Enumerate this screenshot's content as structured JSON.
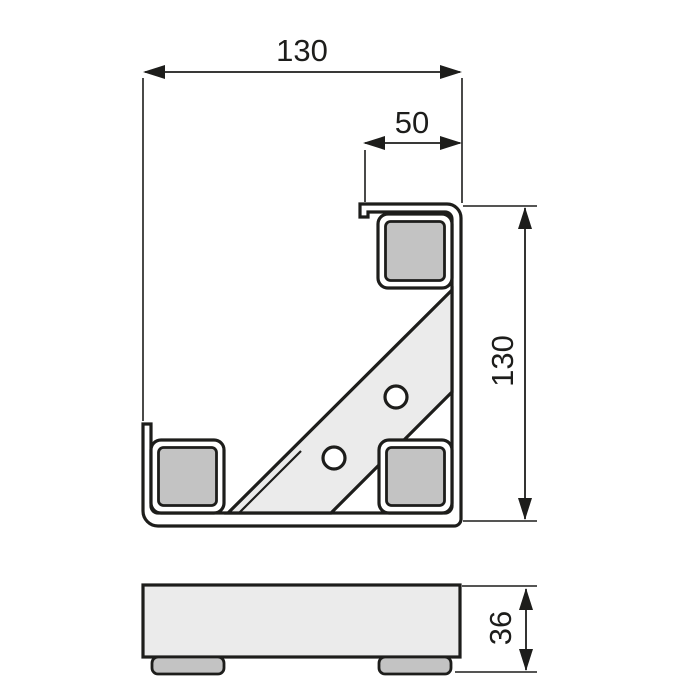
{
  "dimensions": {
    "overall_width": {
      "label": "130"
    },
    "flange_width": {
      "label": "50"
    },
    "overall_height": {
      "label": "130"
    },
    "profile_height": {
      "label": "36"
    }
  },
  "colors": {
    "line": "#1d1d1b",
    "pad_fill": "#c3c3c3",
    "brace_fill": "#ebebeb",
    "body_fill": "#ebebeb",
    "background": "#ffffff"
  }
}
